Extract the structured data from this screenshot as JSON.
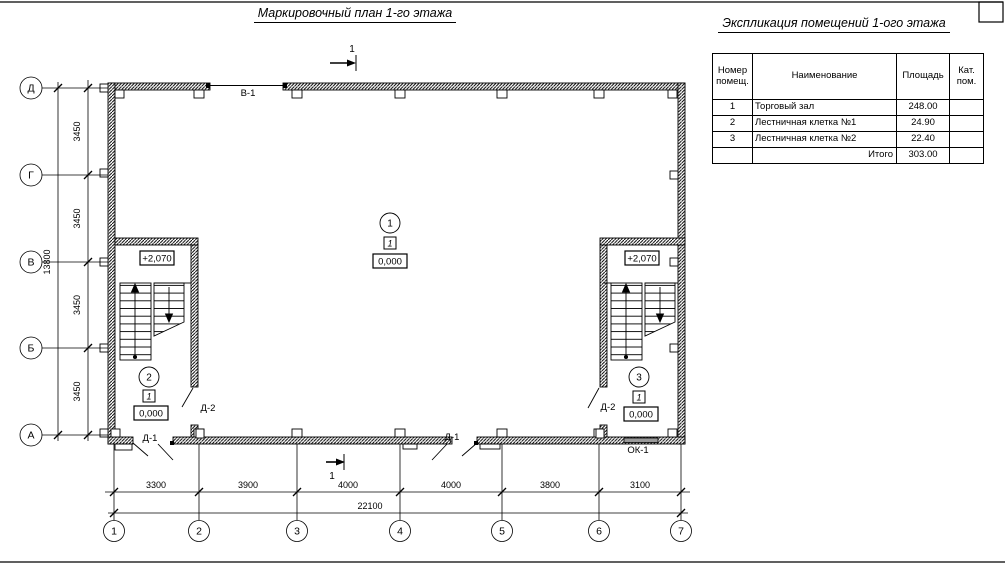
{
  "titles": {
    "plan": "Маркировочный план 1-го этажа",
    "explication": "Экспликация помещений 1-ого этажа"
  },
  "explication_table": {
    "col_room_number": "Номер помещ.",
    "col_name": "Наименование",
    "col_area": "Площадь",
    "col_category": "Кат. пом.",
    "rows": [
      {
        "num": "1",
        "name": "Торговый зал",
        "area": "248.00",
        "cat": ""
      },
      {
        "num": "2",
        "name": "Лестничная клетка №1",
        "area": "24.90",
        "cat": ""
      },
      {
        "num": "3",
        "name": "Лестничная клетка №2",
        "area": "22.40",
        "cat": ""
      }
    ],
    "total_label": "Итого",
    "total_area": "303.00"
  },
  "axes": {
    "rows": [
      "Д",
      "Г",
      "В",
      "Б",
      "А"
    ],
    "cols": [
      "1",
      "2",
      "3",
      "4",
      "5",
      "6",
      "7"
    ]
  },
  "dims": {
    "left_segments": [
      "3450",
      "3450",
      "3450",
      "3450"
    ],
    "left_total": "13800",
    "bottom_segments": [
      "3300",
      "3900",
      "4000",
      "4000",
      "3800",
      "3100"
    ],
    "bottom_total": "22100"
  },
  "marks": {
    "gate_window": "В-1",
    "window": "ОК-1",
    "door_exterior": "Д-1",
    "door_interior": "Д-2",
    "level_ground": "0,000",
    "level_landing": "+2,070",
    "floor_tag": "1",
    "section_label": "1"
  },
  "rooms": [
    {
      "number": "1"
    },
    {
      "number": "2"
    },
    {
      "number": "3"
    }
  ]
}
